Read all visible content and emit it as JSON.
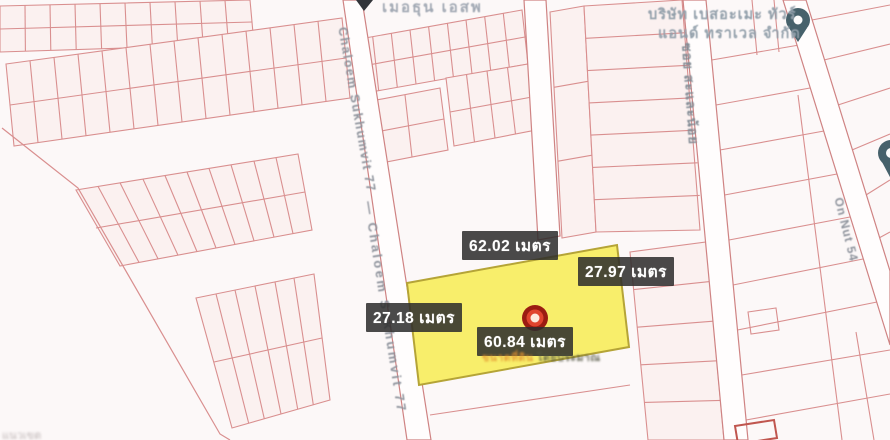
{
  "map": {
    "colors": {
      "background": "#fcf8f8",
      "block_fill": "#fbf1f0",
      "parcel_line": "#d98f8f",
      "road_line": "#cf8383",
      "road_fill": "#fffdfd",
      "highlight_fill": "#f8ee6b",
      "highlight_border": "#b5a437",
      "label_background": "#2c2c2c",
      "label_text": "#ffffff",
      "marker_red": "#b02318",
      "pin_teal": "#46616b"
    },
    "top_place": {
      "name": "เมอธุน เอสพ"
    },
    "company": {
      "name_line1": "บริษัท เบสอะเมะ ทัวร์",
      "name_line2": "แอนด์ ทราเวล จำกัด"
    },
    "roads": {
      "chaloem_upper": "Chaloem Sukhumvit 77",
      "chaloem_lower": "— Chaloem Sukhumvit 77",
      "soi": "ซอย สะและน้อย",
      "on_nut": "On Nut 54"
    },
    "highlight_parcel": {
      "measurements": {
        "top": "62.02 เมตร",
        "right": "27.97 เมตร",
        "left": "27.18 เมตร",
        "bottom": "60.84 เมตร"
      },
      "footnote_part1": "ขนาดที่ดิน",
      "footnote_part2": "โดยประมาณ"
    },
    "corner_note": "แนวเขต"
  }
}
